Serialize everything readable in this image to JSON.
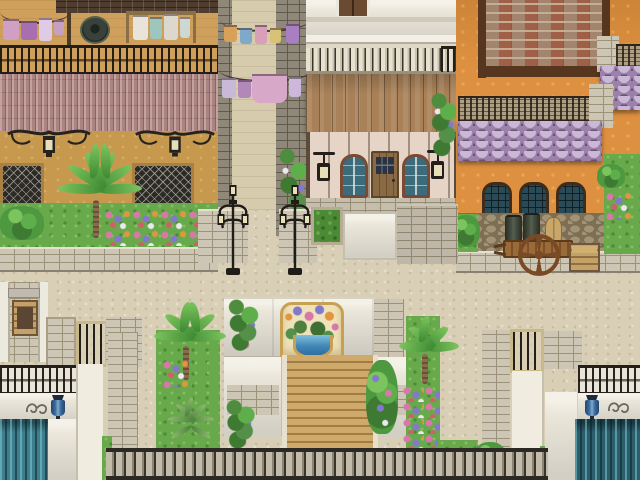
{
  "meta": {
    "type": "game-screenshot",
    "description": "Top-down RPG town scene: sunlit Mediterranean street crossing with three buildings, laundry alley, street lamps, flower plaza with wall fountain and steps, and twin water canals",
    "visible_text": "none"
  },
  "palette": {
    "sand_base": "#d9cfb6",
    "sand_speckle": "#c9bc9e",
    "sand_light": "#e8dfca",
    "tan_wall": "#c6994f",
    "tan_floor": "#cfa05b",
    "brick_roof": "#4e3d2f",
    "iron": "#26221d",
    "mauve_tile": "#ab8381",
    "stone_gray": "#8f8879",
    "stone_gray_joint": "#5f594e",
    "stone_light": "#cec6b4",
    "stone_joint": "#9c9179",
    "alley_floor": "#d7cbae",
    "white_wall": "#eae6da",
    "wood": "#a88158",
    "frame_red": "#7b4a33",
    "glass_teal": "#3c6b7c",
    "glass_dark": "#2a4a56",
    "door_wood": "#8a6a45",
    "orange": "#dd9140",
    "trim_brown": "#56361f",
    "brick_red": "#a06048",
    "mortar": "#c4ad93",
    "scale": "#9c82ab",
    "scale_light": "#cbb7d6",
    "scale_dark": "#665470",
    "cobble": "#a39376",
    "cobble_dark": "#7d6e54",
    "grass": "#67a94b",
    "grass_light": "#84c063",
    "grass_dark": "#4c8a36",
    "palm": "#4e9940",
    "palm_light": "#7cc45e",
    "trunk": "#8a6b4a",
    "flower_pink": "#d878a8",
    "flower_purple": "#8379cc",
    "flower_orange": "#e2953f",
    "flower_red": "#cf5f6a",
    "flower_white": "#ece8f0",
    "fountain_gold": "#c8a052",
    "fountain_cream": "#efe3bb",
    "basin_water": "#3f85b5",
    "steps": "#cfa96a",
    "water": "#2c5d6b",
    "water_left": "#3f7f8d",
    "blue_lamp": "#3a6a9d",
    "bal_stone": "#c4bcab",
    "bal_stone_dark": "#8d8573"
  },
  "scene": {
    "left_building": [
      "rooftop terrace",
      "clothesline with pink and purple laundry",
      "water barrel",
      "drying rack with white towels",
      "iron parapet railing",
      "rose tile awning",
      "two wrought-iron wall lamps",
      "two dark lattice windows",
      "large palm bush",
      "flower bed",
      "stone curb wall"
    ],
    "alley": [
      "gray stone side walls",
      "two clotheslines with hanging laundry",
      "flowering vine"
    ],
    "center_building": [
      "upper brown door",
      "white ledge",
      "balustrade balcony",
      "wooden plank awning",
      "left arched window",
      "front wooden door",
      "right arched window",
      "two hanging wall lanterns",
      "climbing ivy",
      "stone base",
      "hedge planter",
      "white niche"
    ],
    "right_building": [
      "inset red brick panel",
      "dark brown trim",
      "ornate iron parapet bands",
      "purple fish-scale roof tiers",
      "three arched teal windows",
      "cobblestone base wall",
      "stone curb",
      "grass verges with flowers"
    ],
    "street": [
      "sandy pavement crossing",
      "twin black ornate street lamps",
      "low stone walls"
    ],
    "cart": [
      "wooden handcart",
      "spoked wheel",
      "two dark kegs",
      "grain sack",
      "wooden crate"
    ],
    "plaza": [
      "white fountain wall",
      "golden arch niche with flower bouquet",
      "blue water basin",
      "stone pillars",
      "purple flower vines",
      "wooden plank steps",
      "white side wings",
      "palm trees",
      "agave plant",
      "mixed flower beds",
      "stone baluster railing"
    ],
    "canals": [
      "left teal waterfall channel",
      "right teal waterfall channel",
      "white quay walls",
      "iron railings",
      "two blue hanging lamps",
      "gray scroll ornaments",
      "barred stone gates",
      "corner well structure"
    ]
  }
}
